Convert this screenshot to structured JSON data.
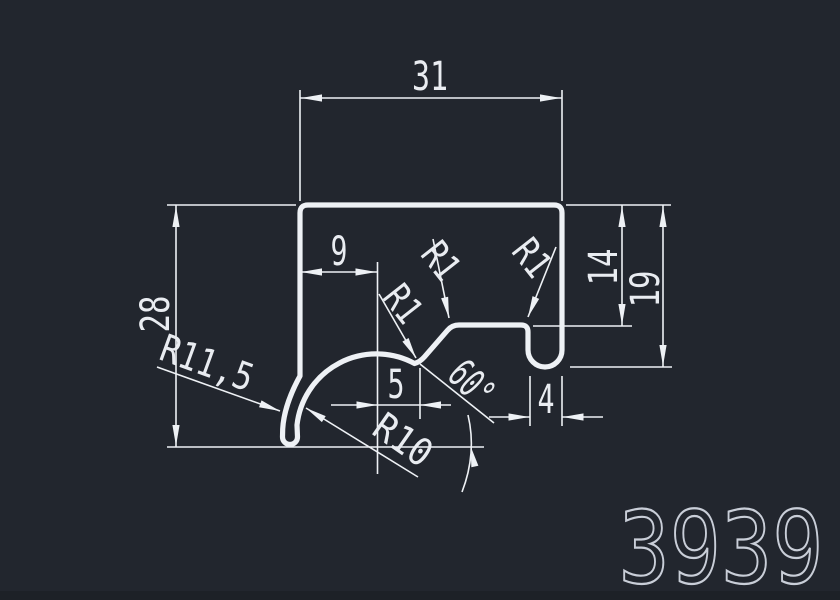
{
  "colors": {
    "background": "#22262e",
    "line": "#eef1f5",
    "text": "#e9ecf1",
    "part_number": "#c9ced8"
  },
  "drawing": {
    "type": "cad-profile-cross-section",
    "part_number": "3939",
    "dimensions": {
      "top_width": {
        "label": "31",
        "value": 31
      },
      "left_height": {
        "label": "28",
        "value": 28
      },
      "left_offset": {
        "label": "9",
        "value": 9
      },
      "notch_offset": {
        "label": "5",
        "value": 5
      },
      "angle": {
        "label": "60°",
        "value": 60
      },
      "inner_depth": {
        "label": "14",
        "value": 14
      },
      "leg_depth": {
        "label": "19",
        "value": 19
      },
      "leg_width": {
        "label": "4",
        "value": 4
      }
    },
    "radii": {
      "hook_outer": {
        "label": "R11,5",
        "value": 11.5
      },
      "hook_inner": {
        "label": "R10",
        "value": 10
      },
      "fillet_left": {
        "label": "R1",
        "value": 1
      },
      "fillet_mid": {
        "label": "R1",
        "value": 1
      },
      "fillet_right": {
        "label": "R1",
        "value": 1
      }
    }
  }
}
